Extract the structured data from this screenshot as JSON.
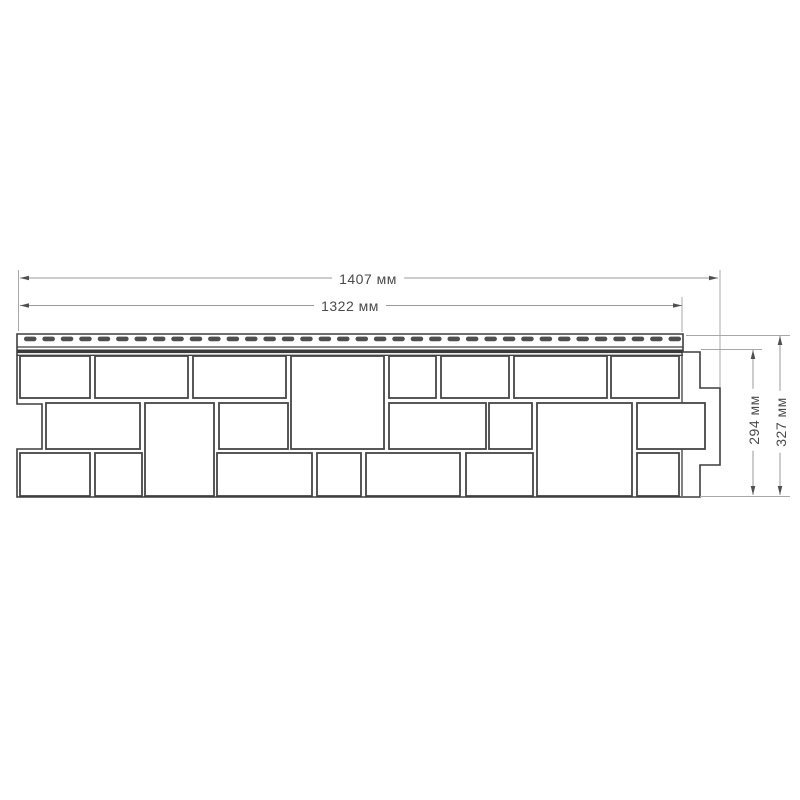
{
  "drawing": {
    "type": "technical-drawing",
    "subject": "facade-siding-panel-front-view",
    "units": "мм",
    "values_mm": {
      "total_width": 1407,
      "face_width": 1322,
      "face_height": 294,
      "total_height": 327
    },
    "labels": {
      "total_width": {
        "text": "1407 мм",
        "x": 368,
        "y": 279,
        "rotate": 0
      },
      "face_width": {
        "text": "1322 мм",
        "x": 350,
        "y": 306,
        "rotate": 0
      },
      "face_height": {
        "text": "294 мм",
        "x": 754,
        "y": 420,
        "rotate": -90
      },
      "total_height": {
        "text": "327 мм",
        "x": 781,
        "y": 422,
        "rotate": -90
      }
    },
    "colors": {
      "background": "#ffffff",
      "panel_line": "#3f3f3f",
      "stone_line": "#454545",
      "stone_fill": "#ffffff",
      "dim_line": "#9a9a9a",
      "ext_line": "#a8a8a8",
      "arrow_fill": "#4f4f4f",
      "slot_fill": "#4f4f4f",
      "lock_band": "#3a3a3a",
      "text": "#4a4a4a"
    },
    "geometry": {
      "outline_path": "M 17 334 L 683 334 L 683 352 L 700 352 L 700 388 L 720 388 L 720 465 L 700 465 L 700 497 L 17 497 L 17 449 L 42 449 L 42 404 L 17 404 Z",
      "strip_lines": [
        {
          "x1": 17,
          "y1": 347,
          "x2": 683,
          "y2": 347
        },
        {
          "x1": 17,
          "y1": 355.3,
          "x2": 683,
          "y2": 355.3
        }
      ],
      "lock_band": {
        "x": 17,
        "y": 349.5,
        "w": 666,
        "h": 3.6
      },
      "face_right_line": {
        "x1": 682,
        "y1": 352,
        "x2": 682,
        "y2": 496
      },
      "slots": {
        "x_start": 24,
        "x_end": 681,
        "count": 36,
        "width": 12.5,
        "height": 4.6,
        "y": 336.6,
        "rx": 2.2
      },
      "stones": [
        [
          20,
          356,
          70,
          42
        ],
        [
          95,
          356,
          93,
          42
        ],
        [
          193,
          356,
          93,
          42
        ],
        [
          389,
          356,
          47,
          42
        ],
        [
          441,
          356,
          68,
          42
        ],
        [
          514,
          356,
          93,
          42
        ],
        [
          611,
          356,
          68,
          42
        ],
        [
          291,
          356,
          93,
          93
        ],
        [
          46,
          403,
          94,
          46
        ],
        [
          219,
          403,
          69,
          46
        ],
        [
          389,
          403,
          97,
          46
        ],
        [
          489,
          403,
          43,
          46
        ],
        [
          637,
          403,
          68,
          46
        ],
        [
          145,
          403,
          69,
          93
        ],
        [
          537,
          403,
          95,
          93
        ],
        [
          20,
          453,
          70,
          43
        ],
        [
          95,
          453,
          47,
          43
        ],
        [
          217,
          453,
          95,
          43
        ],
        [
          317,
          453,
          44,
          43
        ],
        [
          366,
          453,
          94,
          43
        ],
        [
          466,
          453,
          67,
          43
        ],
        [
          637,
          453,
          42,
          43
        ]
      ],
      "ext_lines": [
        {
          "x1": 18.5,
          "y1": 270,
          "x2": 18.5,
          "y2": 331
        },
        {
          "x1": 720,
          "y1": 270,
          "x2": 720,
          "y2": 387
        },
        {
          "x1": 682,
          "y1": 297,
          "x2": 682,
          "y2": 332
        },
        {
          "x1": 701,
          "y1": 349.5,
          "x2": 762,
          "y2": 349.5
        },
        {
          "x1": 686,
          "y1": 335.5,
          "x2": 790,
          "y2": 335.5
        },
        {
          "x1": 700,
          "y1": 496.5,
          "x2": 790,
          "y2": 496.5
        }
      ],
      "dims": [
        {
          "id": "total_width",
          "orient": "h",
          "y": 278,
          "x1": 20,
          "x2": 718
        },
        {
          "id": "face_width",
          "orient": "h",
          "y": 305.5,
          "x1": 20,
          "x2": 682
        },
        {
          "id": "face_height",
          "orient": "v",
          "x": 753,
          "y1": 350,
          "y2": 495
        },
        {
          "id": "total_height",
          "orient": "v",
          "x": 780,
          "y1": 336,
          "y2": 495
        }
      ]
    }
  }
}
